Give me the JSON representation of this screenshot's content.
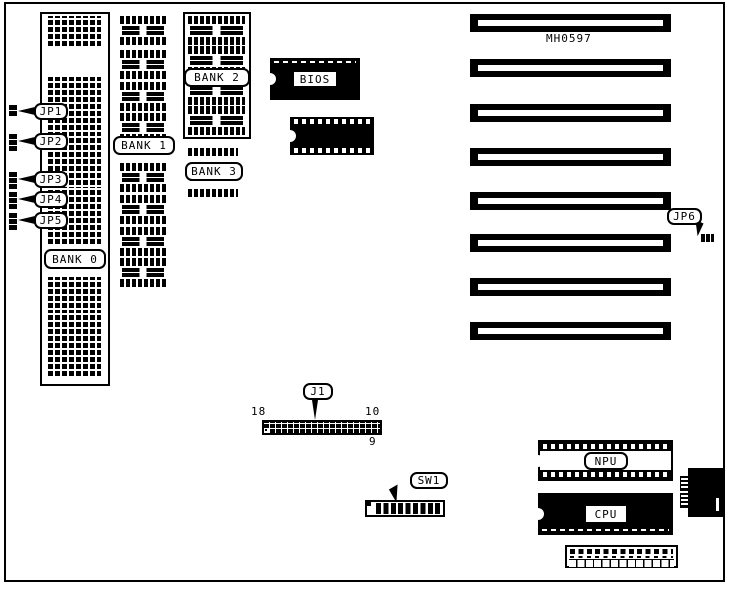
{
  "board": {
    "model": "MH0597",
    "jumpers": {
      "jp1": "JP1",
      "jp2": "JP2",
      "jp3": "JP3",
      "jp4": "JP4",
      "jp5": "JP5",
      "jp6": "JP6"
    },
    "banks": {
      "bank0": "BANK 0",
      "bank1": "BANK 1",
      "bank2": "BANK 2",
      "bank3": "BANK 3"
    },
    "chips": {
      "bios": "BIOS",
      "npu": "NPU",
      "cpu": "CPU"
    },
    "j1": {
      "label": "J1",
      "pin_top_left": "18",
      "pin_top_right": "10",
      "pin_bottom_right": "9"
    },
    "sw1": {
      "label": "SW1"
    }
  }
}
